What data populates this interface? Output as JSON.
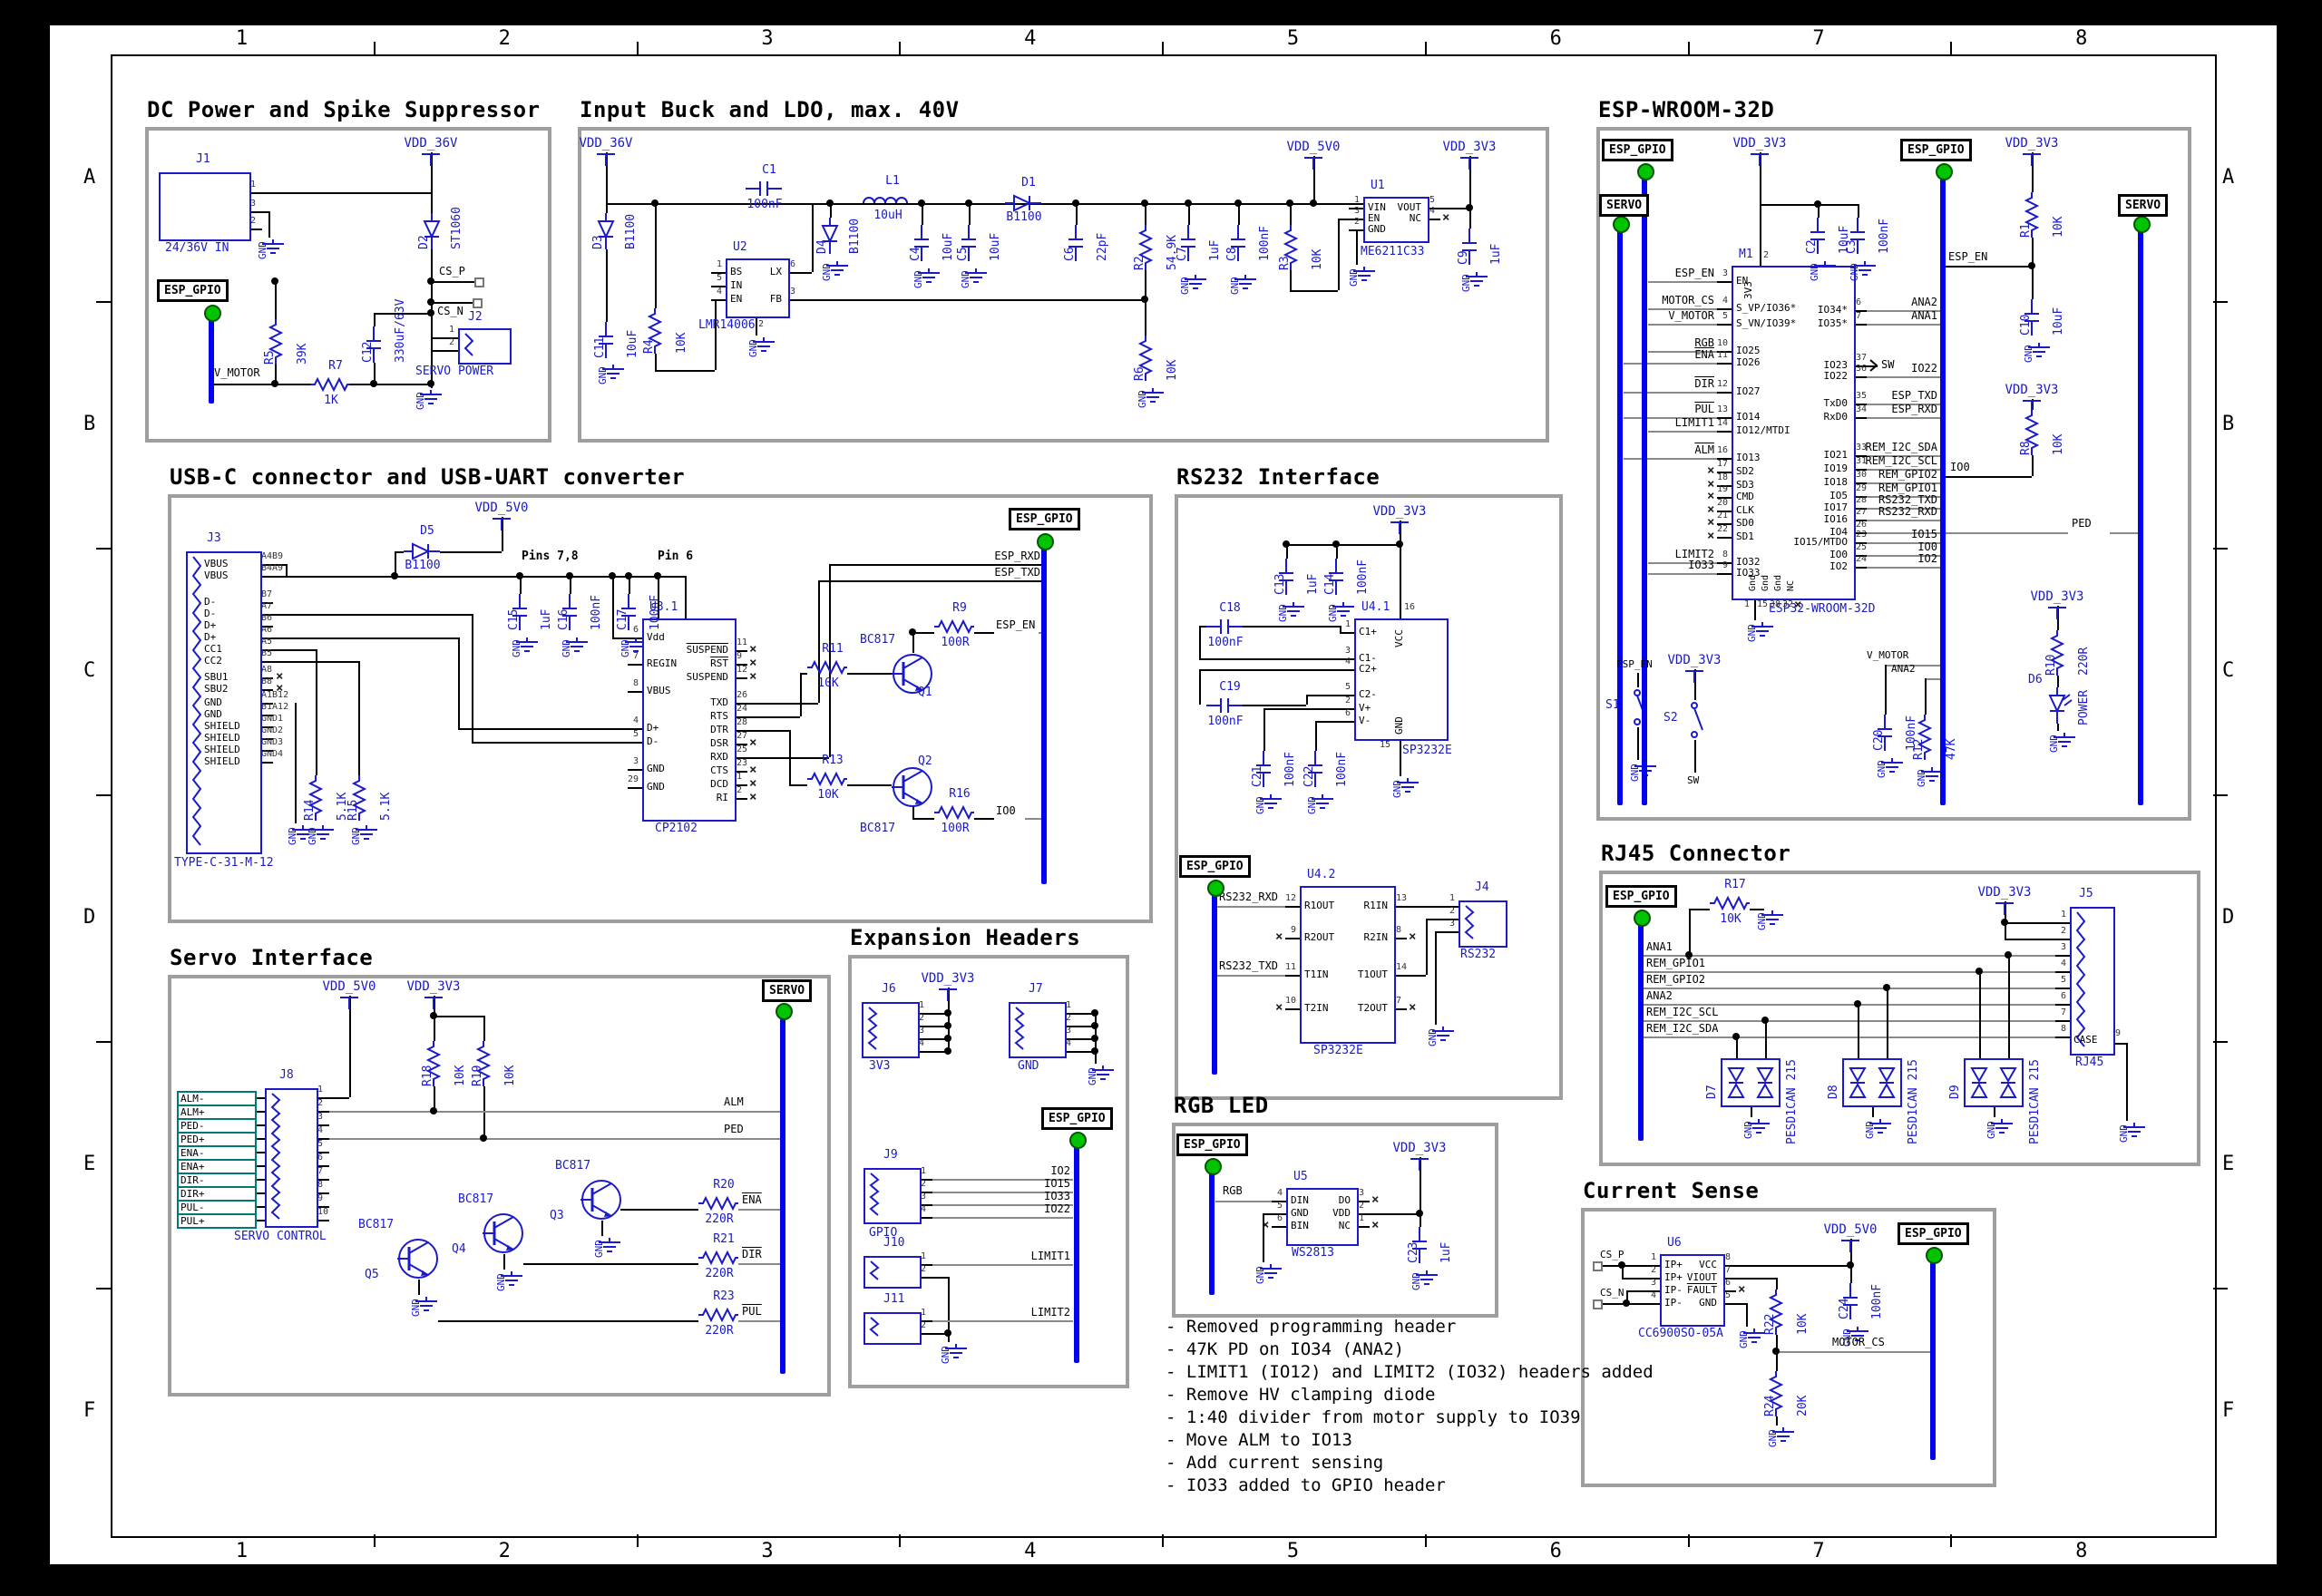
{
  "frame": {
    "cols": [
      "1",
      "2",
      "3",
      "4",
      "5",
      "6",
      "7",
      "8"
    ],
    "rows": [
      "A",
      "B",
      "C",
      "D",
      "E",
      "F"
    ]
  },
  "colors": {
    "symbol_blue": "#1a1ac8",
    "wire_black": "#000000",
    "leader_gray": "#8a8a8a",
    "bus_blue": "#0202ee",
    "junction_green": "#00c400",
    "field_teal": "#007878",
    "section_gray": "#9e9e9e"
  },
  "power": {
    "vdd36": "VDD_36V",
    "vdd5": "VDD_5V0",
    "vdd3": "VDD_3V3",
    "gnd": "GND"
  },
  "hier": {
    "esp_gpio": "ESP_GPIO",
    "servo": "SERVO"
  },
  "notes": [
    "- Removed programming header",
    "- 47K PD on IO34 (ANA2)",
    "- LIMIT1 (IO12) and LIMIT2 (IO32) headers added",
    "- Remove HV clamping diode",
    "- 1:40 divider from motor supply to IO39",
    "- Move ALM to IO13",
    "- Add current sensing",
    "- IO33 added to GPIO header"
  ],
  "sections": {
    "dc": {
      "title": "DC Power and Spike Suppressor",
      "j1": {
        "ref": "J1",
        "value": "24/36V IN",
        "pins": [
          "1",
          "3",
          "2"
        ]
      },
      "d2": {
        "ref": "D2",
        "value": "ST1060"
      },
      "r5": {
        "ref": "R5",
        "value": "39K"
      },
      "r7": {
        "ref": "R7",
        "value": "1K"
      },
      "c12": {
        "ref": "C12",
        "value": "330uF/63V"
      },
      "j2": {
        "ref": "J2",
        "value": "SERVO POWER",
        "pins": [
          "1",
          "2"
        ]
      },
      "nets": {
        "csp": "CS_P",
        "csn": "CS_N",
        "vmotor": "V_MOTOR"
      }
    },
    "buck": {
      "title": "Input Buck and LDO, max. 40V",
      "d3": {
        "ref": "D3",
        "value": "B1100"
      },
      "c11": {
        "ref": "C11",
        "value": "10uF"
      },
      "r4": {
        "ref": "R4",
        "value": "10K"
      },
      "c1": {
        "ref": "C1",
        "value": "100nF"
      },
      "u2": {
        "ref": "U2",
        "value": "LMR14006",
        "left": [
          [
            "1",
            "BS"
          ],
          [
            "5",
            "IN"
          ],
          [
            "4",
            "EN"
          ]
        ],
        "right": [
          [
            "6",
            "LX"
          ],
          [
            "3",
            "FB"
          ]
        ],
        "bottom": [
          [
            "2",
            "GND"
          ]
        ]
      },
      "d4": {
        "ref": "D4",
        "value": "B1100"
      },
      "l1": {
        "ref": "L1",
        "value": "10uH"
      },
      "c4": {
        "ref": "C4",
        "value": "10uF"
      },
      "c5": {
        "ref": "C5",
        "value": "10uF"
      },
      "d1": {
        "ref": "D1",
        "value": "B1100"
      },
      "c6": {
        "ref": "C6",
        "value": "22pF"
      },
      "r2": {
        "ref": "R2",
        "value": "54.9K"
      },
      "c7": {
        "ref": "C7",
        "value": "1uF"
      },
      "c8": {
        "ref": "C8",
        "value": "100nF"
      },
      "r3": {
        "ref": "R3",
        "value": "10K"
      },
      "r6": {
        "ref": "R6",
        "value": "10K"
      },
      "u1": {
        "ref": "U1",
        "value": "ME6211C33",
        "left": [
          [
            "1",
            "VIN"
          ],
          [
            "3",
            "EN"
          ],
          [
            "2",
            "GND"
          ]
        ],
        "right": [
          [
            "5",
            "VOUT"
          ],
          [
            "4",
            "NC",
            "x"
          ]
        ]
      },
      "c9": {
        "ref": "C9",
        "value": "1uF"
      }
    },
    "usb": {
      "title": "USB-C connector and USB-UART converter",
      "j3": {
        "ref": "J3",
        "value": "TYPE-C-31-M-12",
        "pins": [
          [
            "A4B9",
            "VBUS"
          ],
          [
            "B4A9",
            "VBUS"
          ],
          [
            "B7",
            "D-"
          ],
          [
            "A7",
            "D-"
          ],
          [
            "B6",
            "D+"
          ],
          [
            "A6",
            "D+"
          ],
          [
            "A5",
            "CC1"
          ],
          [
            "B5",
            "CC2"
          ],
          [
            "A8",
            "SBU1",
            "x"
          ],
          [
            "B8",
            "SBU2",
            "x"
          ],
          [
            "A1B12",
            "GND"
          ],
          [
            "B1A12",
            "GND"
          ],
          [
            "GND1",
            "SHIELD"
          ],
          [
            "GND2",
            "SHIELD"
          ],
          [
            "GND3",
            "SHIELD"
          ],
          [
            "GND4",
            "SHIELD"
          ]
        ]
      },
      "d5": {
        "ref": "D5",
        "value": "B1100"
      },
      "c15": {
        "ref": "C15",
        "value": "1uF"
      },
      "c16": {
        "ref": "C16",
        "value": "100nF"
      },
      "c17": {
        "ref": "C17",
        "value": "100nF"
      },
      "r14": {
        "ref": "R14",
        "value": "5.1K"
      },
      "r15": {
        "ref": "R15",
        "value": "5.1K"
      },
      "u3": {
        "ref": "U3.1",
        "value": "CP2102",
        "left": [
          [
            "6",
            "Vdd"
          ],
          [
            "7",
            "REGIN"
          ],
          [
            "8",
            "VBUS"
          ],
          [
            "4",
            "D+"
          ],
          [
            "5",
            "D-"
          ],
          [
            "3",
            "GND"
          ],
          [
            "29",
            "GND"
          ]
        ],
        "right": [
          [
            "11",
            "SUSPEND",
            "xb"
          ],
          [
            "9",
            "RST",
            "xb"
          ],
          [
            "12",
            "SUSPEND",
            "x"
          ],
          [
            "26",
            "TXD"
          ],
          [
            "24",
            "RTS"
          ],
          [
            "28",
            "DTR"
          ],
          [
            "27",
            "DSR",
            "x"
          ],
          [
            "25",
            "RXD"
          ],
          [
            "23",
            "CTS",
            "x"
          ],
          [
            "1",
            "DCD",
            "x"
          ],
          [
            "2",
            "RI",
            "x"
          ]
        ]
      },
      "r11": {
        "ref": "R11",
        "value": "10K"
      },
      "q1": {
        "ref": "Q1",
        "value": "BC817"
      },
      "r9": {
        "ref": "R9",
        "value": "100R"
      },
      "r13": {
        "ref": "R13",
        "value": "10K"
      },
      "q2": {
        "ref": "Q2",
        "value": "BC817"
      },
      "r16": {
        "ref": "R16",
        "value": "100R"
      },
      "ann": {
        "pins78": "Pins 7,8",
        "pin6": "Pin 6"
      },
      "nets": {
        "esp_rxd": "ESP_RXD",
        "esp_txd": "ESP_TXD",
        "esp_en": "ESP_EN",
        "io0": "IO0"
      }
    },
    "rs232": {
      "title": "RS232 Interface",
      "c13": {
        "ref": "C13",
        "value": "1uF"
      },
      "c14": {
        "ref": "C14",
        "value": "100nF"
      },
      "c18": {
        "ref": "C18",
        "value": "100nF"
      },
      "c19": {
        "ref": "C19",
        "value": "100nF"
      },
      "c21": {
        "ref": "C21",
        "value": "100nF"
      },
      "c22": {
        "ref": "C22",
        "value": "100nF"
      },
      "u41": {
        "ref": "U4.1",
        "value": "SP3232E",
        "left": [
          [
            "1",
            "C1+"
          ],
          [
            "3",
            "C1-"
          ],
          [
            "4",
            "C2+"
          ],
          [
            "5",
            "C2-"
          ],
          [
            "2",
            "V+"
          ],
          [
            "6",
            "V-"
          ]
        ],
        "top": [
          [
            "16",
            "VCC"
          ]
        ],
        "bottom": [
          [
            "15",
            "GND"
          ]
        ]
      },
      "u42": {
        "ref": "U4.2",
        "value": "SP3232E",
        "left": [
          [
            "12",
            "R1OUT"
          ],
          [
            "9",
            "R2OUT",
            "x"
          ],
          [
            "11",
            "T1IN"
          ],
          [
            "10",
            "T2IN",
            "x"
          ]
        ],
        "right": [
          [
            "13",
            "R1IN"
          ],
          [
            "8",
            "R2IN",
            "x"
          ],
          [
            "14",
            "T1OUT"
          ],
          [
            "7",
            "T2OUT",
            "x"
          ]
        ]
      },
      "j4": {
        "ref": "J4",
        "value": "RS232",
        "pins": [
          "1",
          "2",
          "3"
        ]
      },
      "nets": {
        "rxd": "RS232_RXD",
        "txd": "RS232_TXD"
      }
    },
    "esp": {
      "title": "ESP-WROOM-32D",
      "c2": {
        "ref": "C2",
        "value": "10uF"
      },
      "c3": {
        "ref": "C3",
        "value": "100nF"
      },
      "r1": {
        "ref": "R1",
        "value": "10K"
      },
      "c10": {
        "ref": "C10",
        "value": "10uF"
      },
      "m1": {
        "ref": "M1",
        "value": "ESP32-WROOM-32D",
        "left": [
          [
            "3",
            "EN"
          ],
          [
            "4",
            "S_VP/IO36*"
          ],
          [
            "5",
            "S_VN/IO39*"
          ],
          [
            "10",
            "IO25"
          ],
          [
            "11",
            "IO26"
          ],
          [
            "12",
            "IO27"
          ],
          [
            "13",
            "IO14"
          ],
          [
            "14",
            "IO12/MTDI"
          ],
          [
            "16",
            "IO13"
          ],
          [
            "17",
            "SD2",
            "x"
          ],
          [
            "18",
            "SD3",
            "x"
          ],
          [
            "19",
            "CMD",
            "x"
          ],
          [
            "20",
            "CLK",
            "x"
          ],
          [
            "21",
            "SD0",
            "x"
          ],
          [
            "22",
            "SD1",
            "x"
          ],
          [
            "8",
            "IO32"
          ],
          [
            "9",
            "IO33"
          ]
        ],
        "right": [
          [
            "6",
            "IO34*"
          ],
          [
            "7",
            "IO35*"
          ],
          [
            "37",
            "IO23"
          ],
          [
            "36",
            "IO22"
          ],
          [
            "35",
            "TxD0"
          ],
          [
            "34",
            "RxD0"
          ],
          [
            "33",
            "IO21"
          ],
          [
            "31",
            "IO19"
          ],
          [
            "30",
            "IO18"
          ],
          [
            "29",
            "IO5"
          ],
          [
            "28",
            "IO17"
          ],
          [
            "27",
            "IO16"
          ],
          [
            "26",
            "IO4"
          ],
          [
            "23",
            "IO15/MTDO"
          ],
          [
            "25",
            "IO0"
          ],
          [
            "24",
            "IO2"
          ]
        ],
        "top": [
          [
            "2",
            "3V3"
          ]
        ],
        "bottom": [
          [
            "1",
            "Gnd"
          ],
          [
            "15",
            "Gnd"
          ],
          [
            "38",
            "Gnd"
          ],
          [
            "32",
            "NC",
            "x"
          ]
        ]
      },
      "left_nets": [
        "ESP_EN",
        "MOTOR_CS",
        "V_MOTOR",
        "RGB",
        "ENA",
        "DIR",
        "PUL",
        "LIMIT1",
        "ALM",
        "LIMIT2",
        "IO33"
      ],
      "right_nets": [
        "ANA2",
        "ANA1",
        "SW",
        "IO22",
        "ESP_TXD",
        "ESP_RXD",
        "REM_I2C_SDA",
        "REM_I2C_SCL",
        "REM_GPIO2",
        "REM_GPIO1",
        "RS232_TXD",
        "RS232_RXD",
        "PED",
        "IO15",
        "IO0",
        "IO2"
      ],
      "esp_en": "ESP_EN",
      "io0": "IO0",
      "sw": "SW",
      "vmotor": "V_MOTOR",
      "ana2": "ANA2",
      "ped": "PED",
      "s1": {
        "ref": "S1"
      },
      "s2": {
        "ref": "S2"
      },
      "r8": {
        "ref": "R8",
        "value": "10K"
      },
      "c20": {
        "ref": "C20",
        "value": "100nF"
      },
      "r12": {
        "ref": "R12",
        "value": "47K"
      },
      "r10": {
        "ref": "R10",
        "value": "220R"
      },
      "d6": {
        "ref": "D6",
        "value": "POWER"
      }
    },
    "servo": {
      "title": "Servo Interface",
      "r18": {
        "ref": "R18",
        "value": "10K"
      },
      "r19": {
        "ref": "R19",
        "value": "10K"
      },
      "j8": {
        "ref": "J8",
        "value": "SERVO CONTROL",
        "pins": [
          "1",
          "2",
          "3",
          "4",
          "5",
          "6",
          "7",
          "8",
          "9",
          "10"
        ]
      },
      "fields": [
        "ALM-",
        "ALM+",
        "PED-",
        "PED+",
        "ENA-",
        "ENA+",
        "DIR-",
        "DIR+",
        "PUL-",
        "PUL+"
      ],
      "q5": {
        "ref": "Q5",
        "value": "BC817"
      },
      "q4": {
        "ref": "Q4",
        "value": "BC817"
      },
      "q3": {
        "ref": "Q3",
        "value": "BC817"
      },
      "r20": {
        "ref": "R20",
        "value": "220R"
      },
      "r21": {
        "ref": "R21",
        "value": "220R"
      },
      "r23": {
        "ref": "R23",
        "value": "220R"
      },
      "nets": {
        "alm": "ALM",
        "ped": "PED",
        "ena": "ENA",
        "dir": "DIR",
        "pul": "PUL"
      }
    },
    "exp": {
      "title": "Expansion Headers",
      "j6": {
        "ref": "J6",
        "value": "3V3",
        "pins": [
          "1",
          "2",
          "3",
          "4"
        ]
      },
      "j7": {
        "ref": "J7",
        "value": "GND",
        "pins": [
          "1",
          "2",
          "3",
          "4"
        ]
      },
      "j9": {
        "ref": "J9",
        "value": "GPIO",
        "pins": [
          "1",
          "2",
          "3",
          "4"
        ]
      },
      "j10": {
        "ref": "J10",
        "pins": [
          "1",
          "2"
        ]
      },
      "j11": {
        "ref": "J11",
        "pins": [
          "1",
          "2"
        ]
      },
      "nets": {
        "io2": "IO2",
        "io15": "IO15",
        "io33": "IO33",
        "io22": "IO22",
        "limit1": "LIMIT1",
        "limit2": "LIMIT2"
      }
    },
    "rgb": {
      "title": "RGB LED",
      "u5": {
        "ref": "U5",
        "value": "WS2813",
        "left": [
          [
            "4",
            "DIN"
          ],
          [
            "5",
            "GND"
          ],
          [
            "6",
            "BIN",
            "x"
          ]
        ],
        "right": [
          [
            "3",
            "DO",
            "x"
          ],
          [
            "2",
            "VDD"
          ],
          [
            "1",
            "NC",
            "x"
          ]
        ]
      },
      "c23": {
        "ref": "C23",
        "value": "1uF"
      },
      "nets": {
        "rgb": "RGB"
      }
    },
    "rj45": {
      "title": "RJ45 Connector",
      "r17": {
        "ref": "R17",
        "value": "10K"
      },
      "j5": {
        "ref": "J5",
        "value": "RJ45",
        "pins": [
          "1",
          "2",
          "3",
          "4",
          "5",
          "6",
          "7",
          "8"
        ],
        "case": [
          "9",
          "CASE"
        ]
      },
      "d7": {
        "ref": "D7",
        "value": "PESD1CAN 215"
      },
      "d8": {
        "ref": "D8",
        "value": "PESD1CAN 215"
      },
      "d9": {
        "ref": "D9",
        "value": "PESD1CAN 215"
      },
      "nets": [
        "ANA1",
        "REM_GPIO1",
        "REM_GPIO2",
        "ANA2",
        "REM_I2C_SCL",
        "REM_I2C_SDA"
      ]
    },
    "cs": {
      "title": "Current Sense",
      "u6": {
        "ref": "U6",
        "value": "CC6900SO-05A",
        "left": [
          [
            "1",
            "IP+"
          ],
          [
            "2",
            "IP+"
          ],
          [
            "3",
            "IP-"
          ],
          [
            "4",
            "IP-"
          ]
        ],
        "right": [
          [
            "8",
            "VCC"
          ],
          [
            "7",
            "VIOUT"
          ],
          [
            "6",
            "FAULT",
            "xb"
          ],
          [
            "5",
            "GND"
          ]
        ]
      },
      "r22": {
        "ref": "R22",
        "value": "10K"
      },
      "r24": {
        "ref": "R24",
        "value": "20K"
      },
      "c24": {
        "ref": "C24",
        "value": "100nF"
      },
      "nets": {
        "csp": "CS_P",
        "csn": "CS_N",
        "motor_cs": "MOTOR_CS"
      }
    }
  }
}
